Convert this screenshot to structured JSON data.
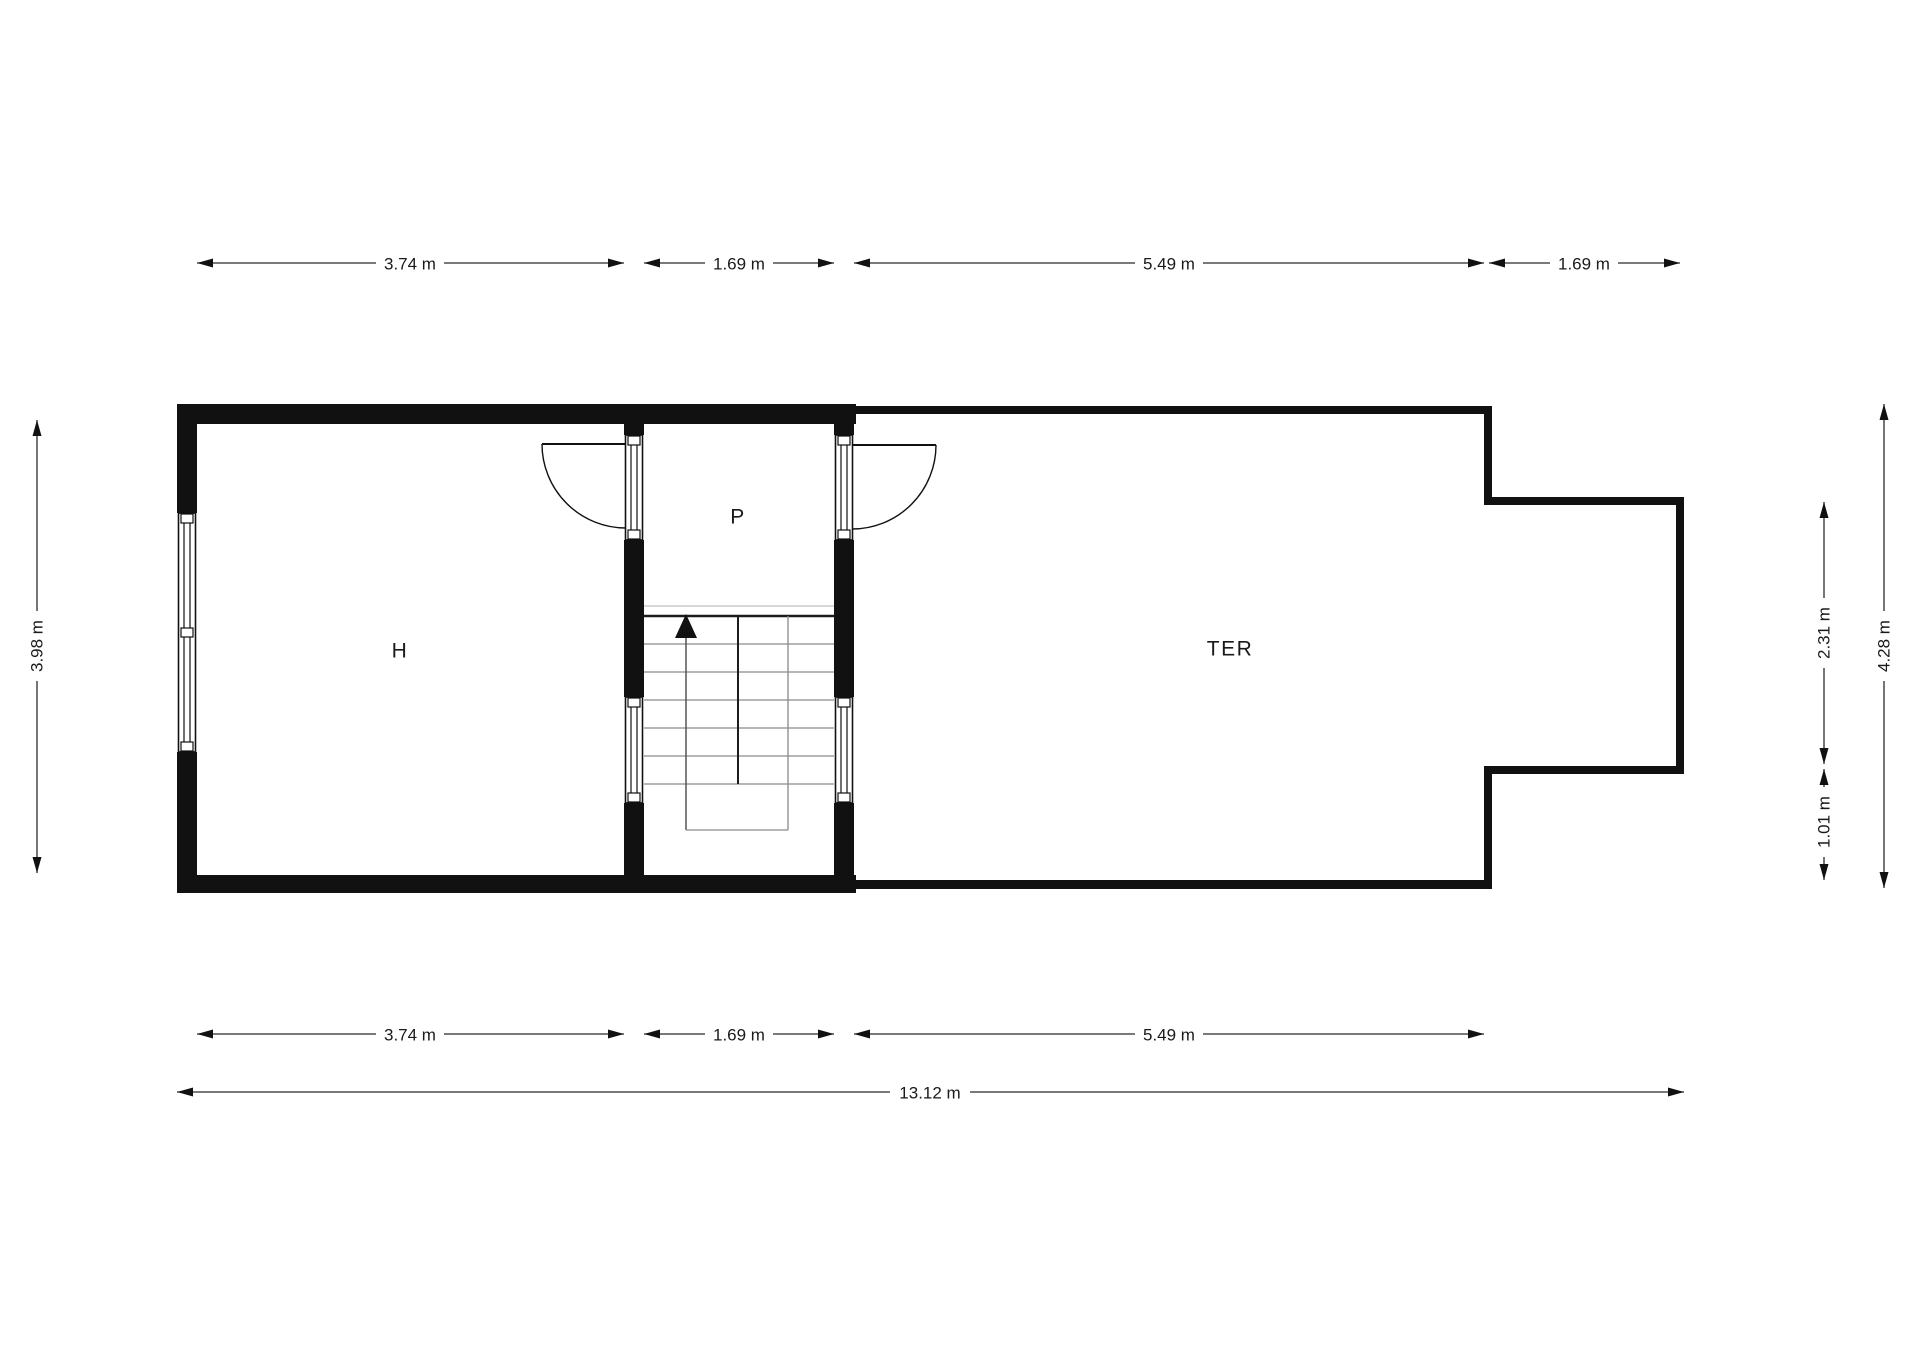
{
  "title": "Floor plan",
  "colors": {
    "background": "#ffffff",
    "wall": "#111111",
    "dimension_line": "#2b2b2b",
    "tread_line": "#8a8a8a",
    "text": "#1a1a1a"
  },
  "rooms": {
    "h": "H",
    "p": "P",
    "ter": "TER"
  },
  "dimensions": {
    "top": [
      "3.74 m",
      "1.69 m",
      "5.49 m",
      "1.69 m"
    ],
    "bottom": [
      "3.74 m",
      "1.69 m",
      "5.49 m"
    ],
    "overall_width": "13.12 m",
    "left_height": "3.98 m",
    "right": {
      "notch_height": "2.31 m",
      "lower_height": "1.01 m",
      "total_height": "4.28 m"
    }
  }
}
